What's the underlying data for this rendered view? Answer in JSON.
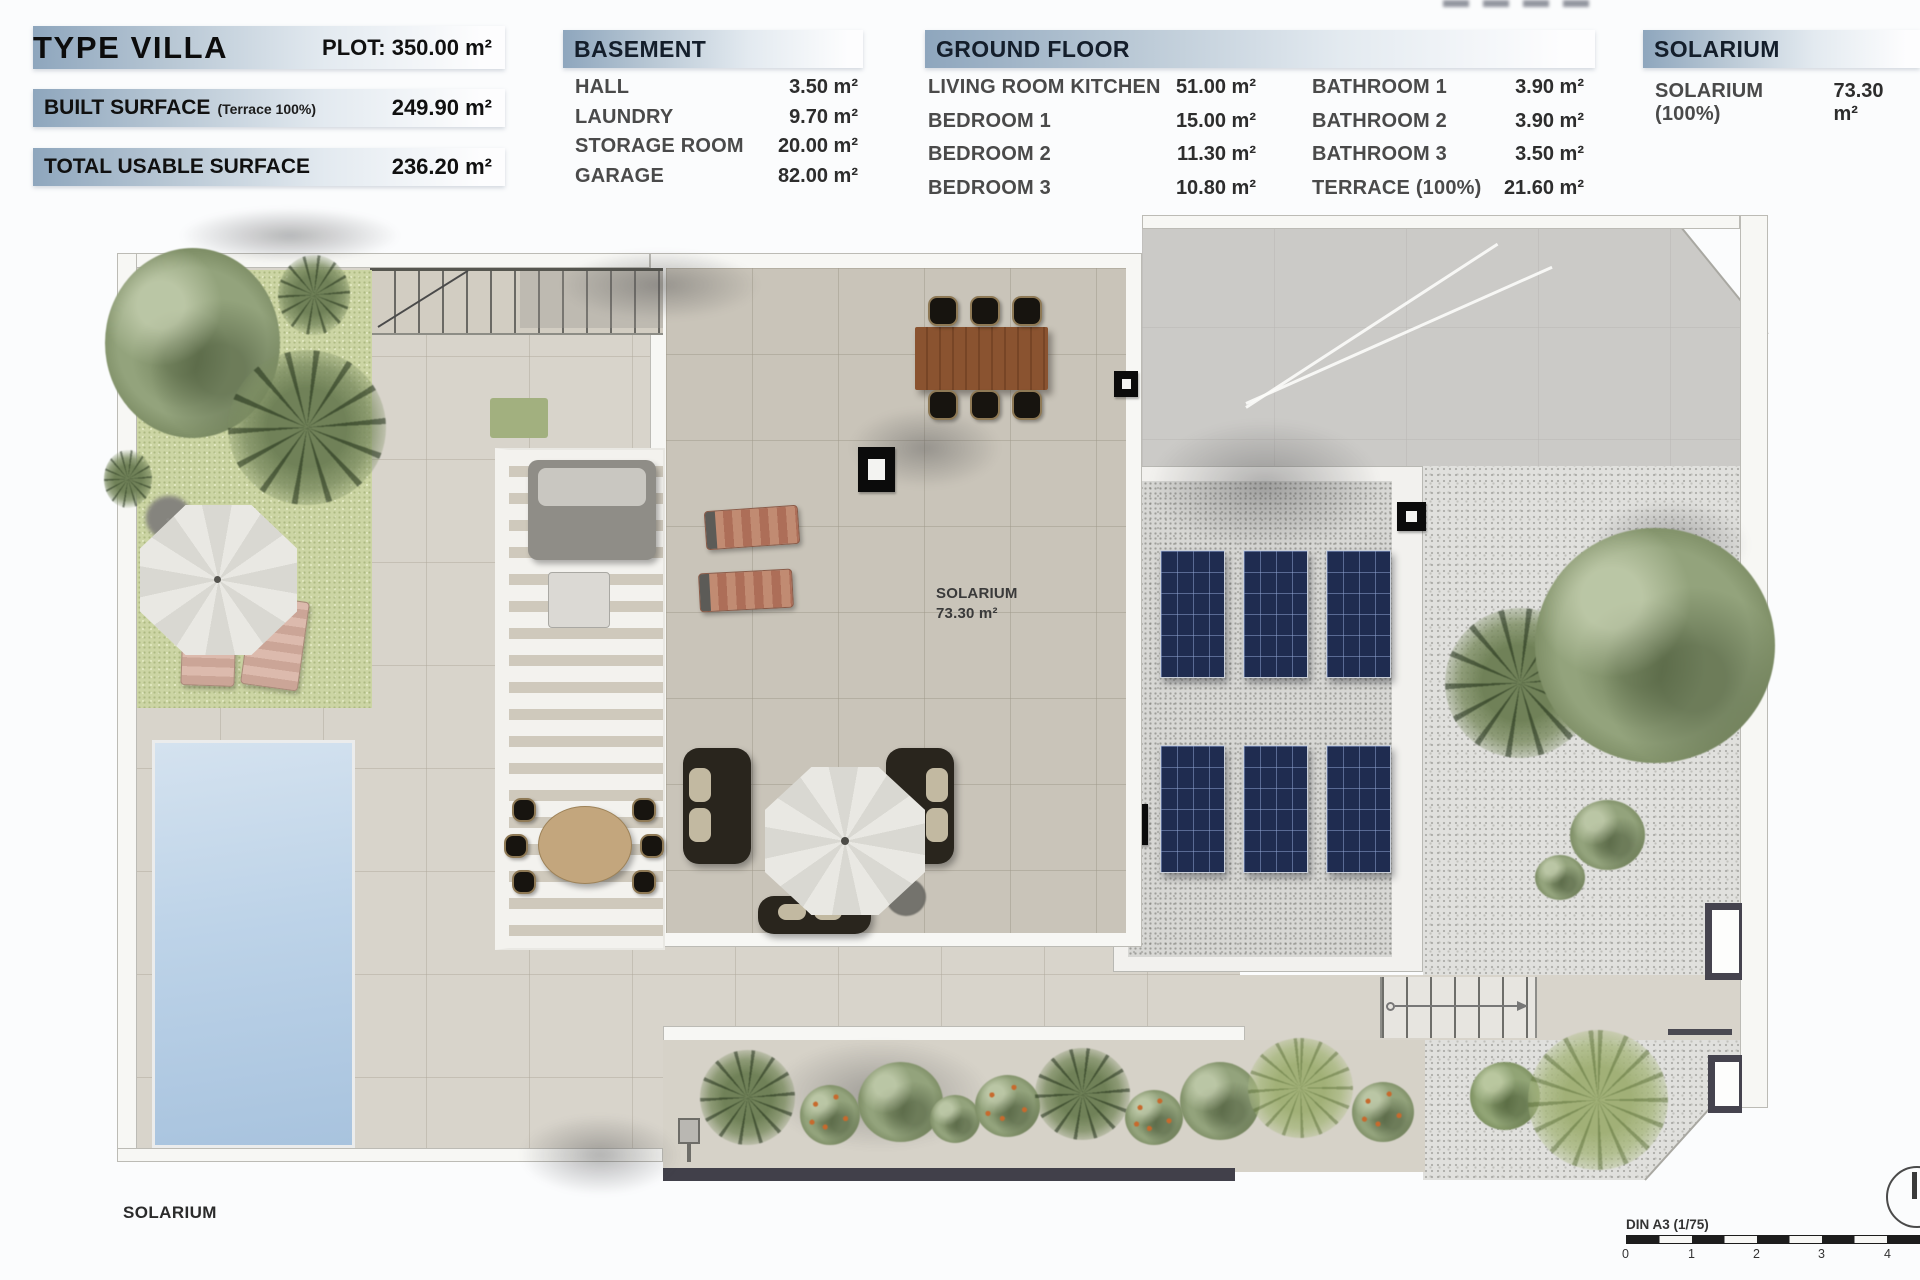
{
  "summary": {
    "title": "TYPE VILLA",
    "plot_label": "PLOT:",
    "plot_value": "350.00 m²",
    "rows": [
      {
        "label": "BUILT SURFACE",
        "note": "(Terrace 100%)",
        "value": "249.90 m²"
      },
      {
        "label": "TOTAL USABLE SURFACE",
        "note": "",
        "value": "236.20 m²"
      }
    ]
  },
  "basement": {
    "title": "BASEMENT",
    "rows": [
      {
        "label": "HALL",
        "value": "3.50 m²"
      },
      {
        "label": "LAUNDRY",
        "value": "9.70 m²"
      },
      {
        "label": "STORAGE ROOM",
        "value": "20.00 m²"
      },
      {
        "label": "GARAGE",
        "value": "82.00 m²"
      }
    ]
  },
  "ground_floor": {
    "title": "GROUND FLOOR",
    "col1": [
      {
        "label": "LIVING ROOM KITCHEN",
        "value": "51.00 m²"
      },
      {
        "label": "BEDROOM 1",
        "value": "15.00 m²"
      },
      {
        "label": "BEDROOM 2",
        "value": "11.30 m²"
      },
      {
        "label": "BEDROOM 3",
        "value": "10.80 m²"
      }
    ],
    "col2": [
      {
        "label": "BATHROOM 1",
        "value": "3.90 m²"
      },
      {
        "label": "BATHROOM 2",
        "value": "3.90 m²"
      },
      {
        "label": "BATHROOM 3",
        "value": "3.50 m²"
      },
      {
        "label": "TERRACE (100%)",
        "value": "21.60 m²"
      }
    ]
  },
  "solarium_table": {
    "title": "SOLARIUM",
    "row": {
      "label": "SOLARIUM (100%)",
      "value": "73.30 m²"
    }
  },
  "plan": {
    "room_label_line1": "SOLARIUM",
    "room_label_line2": "73.30 m²",
    "floor_label": "SOLARIUM"
  },
  "scale_bar": {
    "label": "DIN A3 (1/75)",
    "ticks": [
      "0",
      "1",
      "2",
      "3",
      "4"
    ]
  },
  "colors": {
    "header_bar_start": "#8ea6bd",
    "header_bar_end": "#fdfdfe",
    "tile_beige": "#c9c4b9",
    "concrete_gray": "#cbcac7",
    "lawn_green": "#ccd5a4",
    "pool_blue": "#b0c9e2",
    "solar_panel_navy": "#1f2c50",
    "wood_brown": "#8a5330",
    "wall_dark": "#41404a"
  }
}
